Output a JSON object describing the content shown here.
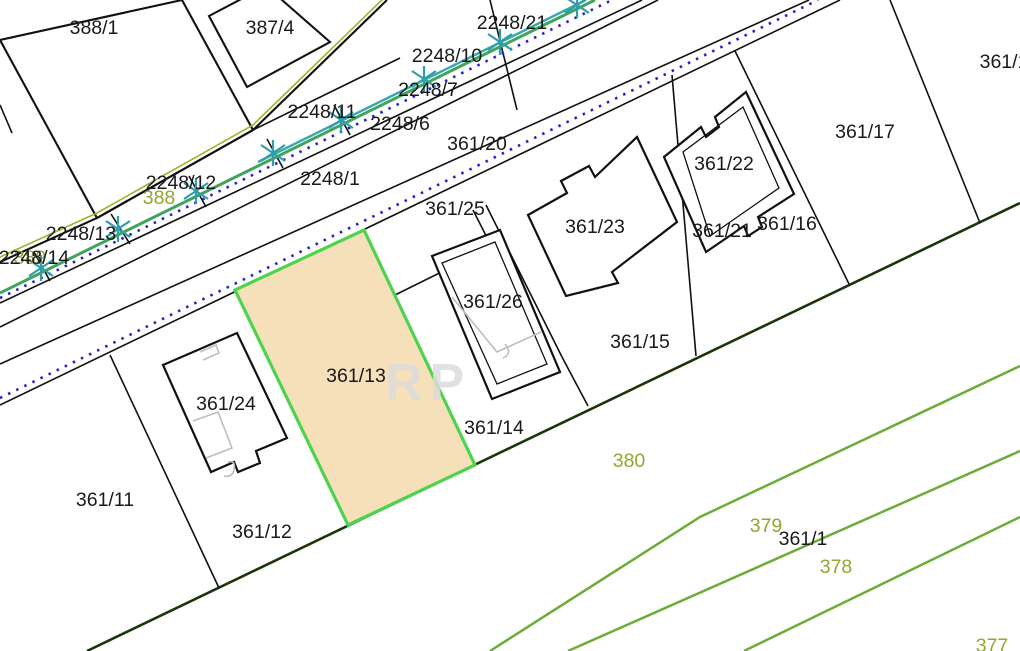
{
  "map": {
    "type": "cadastral-parcel-map",
    "watermark": "RP",
    "highlighted_parcel": {
      "id": "361/13",
      "fill": "#F6E0BA",
      "border": "#4ED34E"
    },
    "colors": {
      "parcel_line": "#111111",
      "rear_boundary_line": "#1B3409",
      "field_line_green": "#6CAC38",
      "utility_line_green": "#41A45E",
      "utility_line_teal": "#39A8AC",
      "utility_dotted_blue": "#2222CC",
      "corridor_olive_line": "#9DB42B",
      "olive_label": "#93A633",
      "building_detail_gray": "#BDBDBD",
      "survey_marker_teal": "#2E9FA8"
    },
    "labels": {
      "black": [
        {
          "text": "388/1",
          "x": 94,
          "y": 28
        },
        {
          "text": "387/4",
          "x": 270,
          "y": 28
        },
        {
          "text": "2248/21",
          "x": 512,
          "y": 23
        },
        {
          "text": "2248/10",
          "x": 447,
          "y": 56
        },
        {
          "text": "2248/7",
          "x": 428,
          "y": 90
        },
        {
          "text": "2248/11",
          "x": 322,
          "y": 112
        },
        {
          "text": "2248/6",
          "x": 400,
          "y": 124
        },
        {
          "text": "361/20",
          "x": 477,
          "y": 144
        },
        {
          "text": "2248/1",
          "x": 330,
          "y": 179
        },
        {
          "text": "2248/12",
          "x": 181,
          "y": 183
        },
        {
          "text": "2248/13",
          "x": 81,
          "y": 234
        },
        {
          "text": "2248/14",
          "x": 34,
          "y": 258
        },
        {
          "text": "361/17",
          "x": 865,
          "y": 132
        },
        {
          "text": "361/1",
          "x": 1004,
          "y": 62
        },
        {
          "text": "361/22",
          "x": 724,
          "y": 164
        },
        {
          "text": "361/16",
          "x": 787,
          "y": 224
        },
        {
          "text": "361/21",
          "x": 722,
          "y": 231
        },
        {
          "text": "361/23",
          "x": 595,
          "y": 227
        },
        {
          "text": "361/25",
          "x": 455,
          "y": 209
        },
        {
          "text": "361/26",
          "x": 493,
          "y": 302
        },
        {
          "text": "361/15",
          "x": 640,
          "y": 342
        },
        {
          "text": "361/13",
          "x": 356,
          "y": 376
        },
        {
          "text": "361/14",
          "x": 494,
          "y": 428
        },
        {
          "text": "361/24",
          "x": 226,
          "y": 404
        },
        {
          "text": "361/11",
          "x": 105,
          "y": 500
        },
        {
          "text": "361/12",
          "x": 262,
          "y": 532
        },
        {
          "text": "361/1",
          "x": 803,
          "y": 539
        }
      ],
      "olive": [
        {
          "text": "389",
          "x": 30,
          "y": 258
        },
        {
          "text": "388",
          "x": 159,
          "y": 198
        },
        {
          "text": "380",
          "x": 629,
          "y": 461
        },
        {
          "text": "379",
          "x": 766,
          "y": 526
        },
        {
          "text": "378",
          "x": 836,
          "y": 567
        },
        {
          "text": "377",
          "x": 992,
          "y": 646
        }
      ]
    },
    "survey_stars": [
      {
        "x": 41,
        "y": 268
      },
      {
        "x": 118,
        "y": 229
      },
      {
        "x": 196,
        "y": 191
      },
      {
        "x": 273,
        "y": 153
      },
      {
        "x": 341,
        "y": 120
      },
      {
        "x": 424,
        "y": 79
      },
      {
        "x": 500,
        "y": 42
      },
      {
        "x": 577,
        "y": 5
      }
    ]
  }
}
